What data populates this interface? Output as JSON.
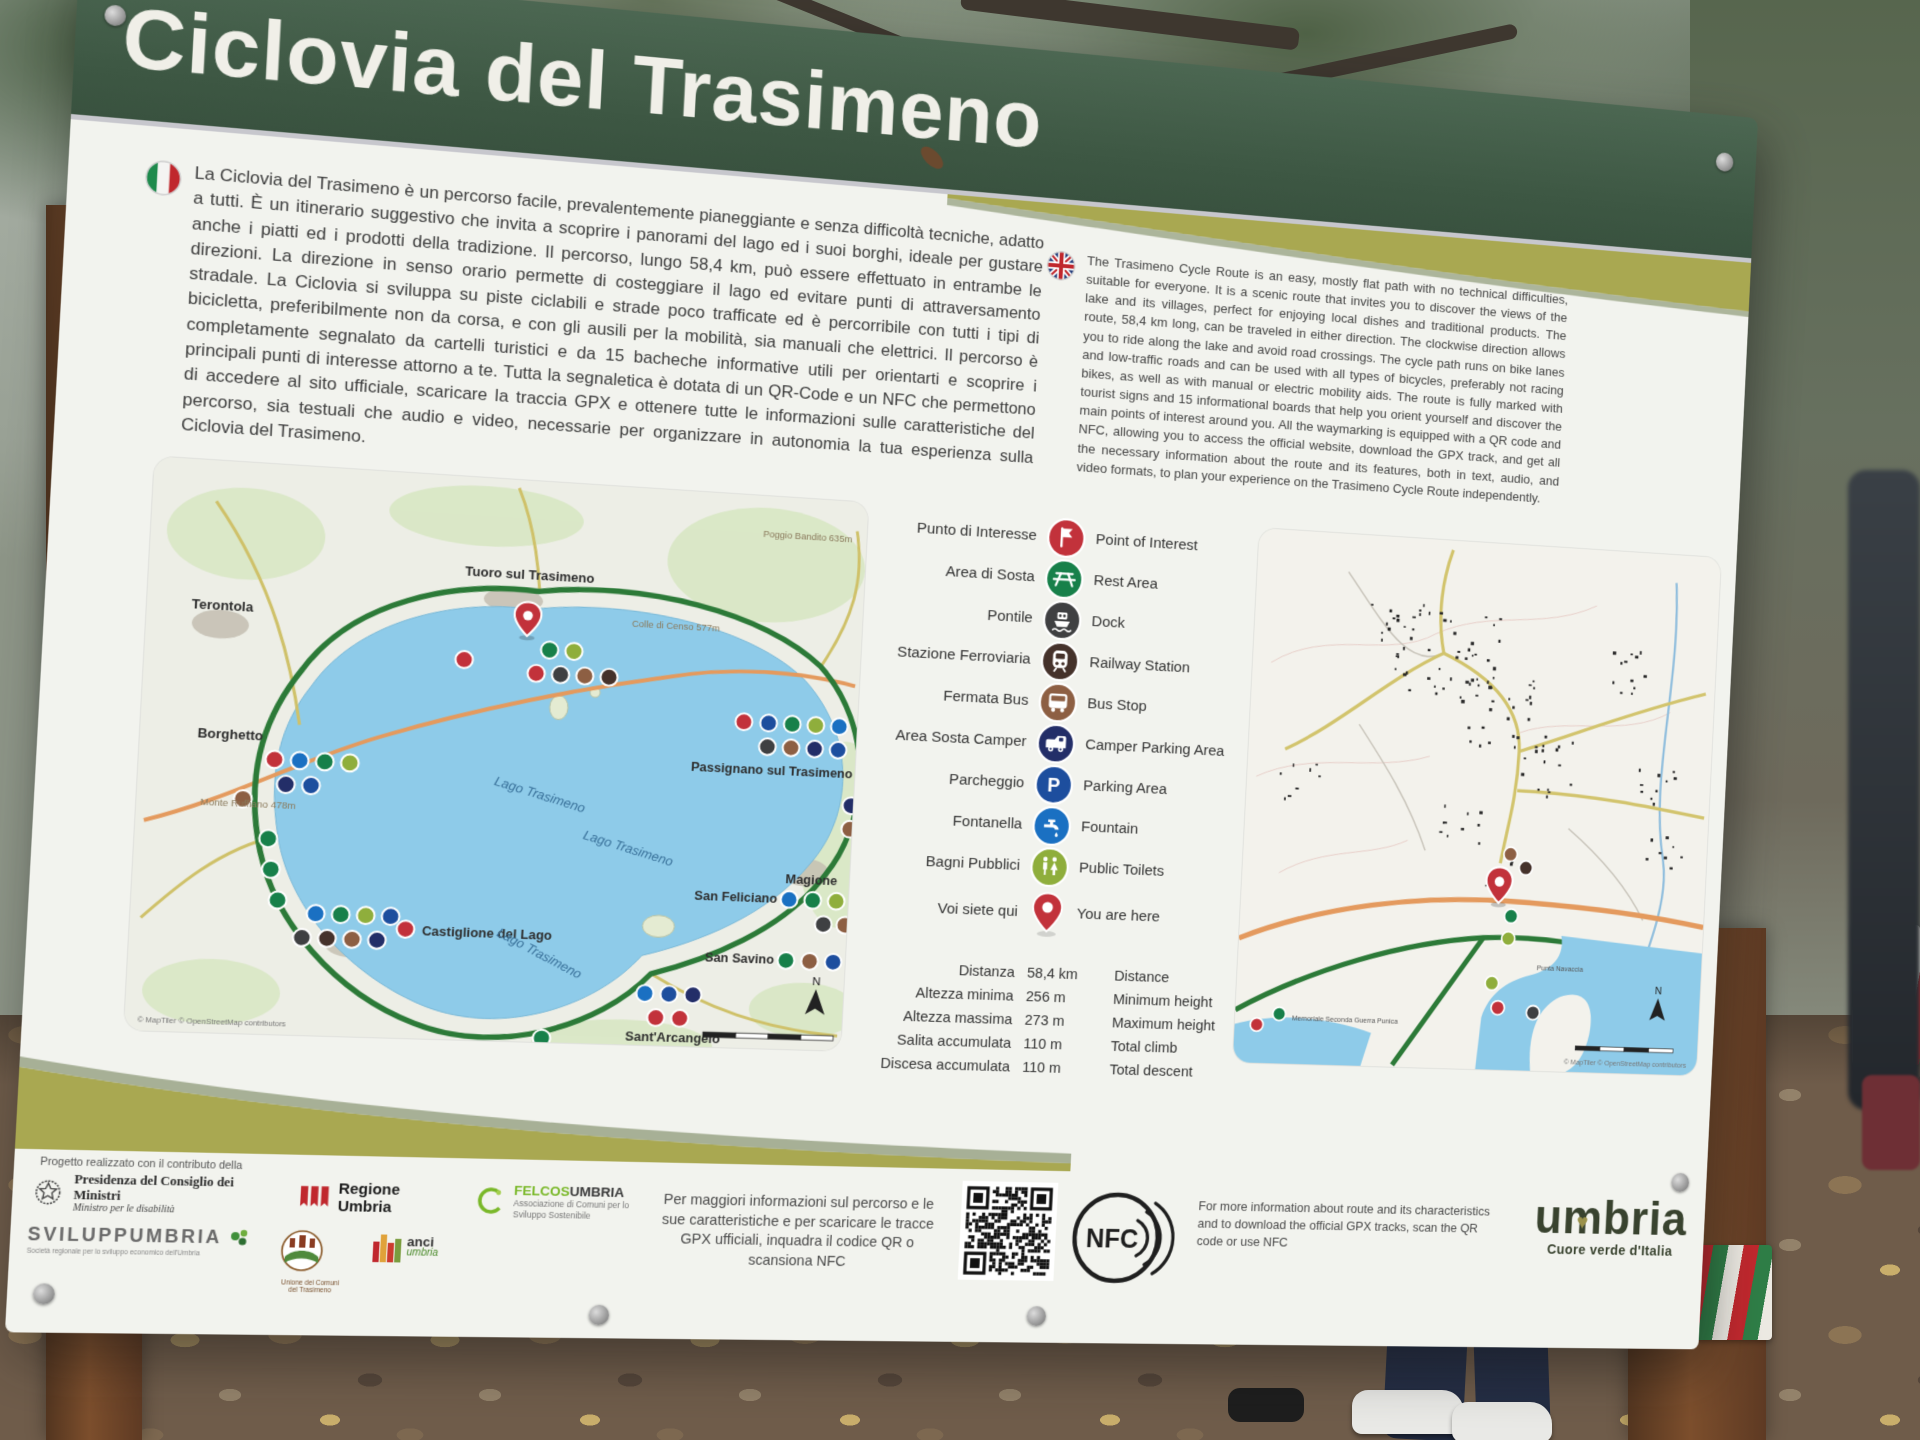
{
  "header": {
    "title": "Ciclovia del Trasimeno"
  },
  "intro": {
    "it": "La Ciclovia del Trasimeno è un percorso facile, prevalentemente pianeggiante e senza difficoltà tecniche, adatto a tutti. È un itinerario suggestivo che invita a scoprire i panorami del lago ed i suoi borghi, ideale per gustare anche i piatti ed i prodotti della tradizione. Il percorso, lungo 58,4 km, può essere effettuato in entrambe le direzioni. La direzione in senso orario permette di costeggiare il lago ed evitare punti di attraversamento stradale. La Ciclovia si sviluppa su piste ciclabili e strade poco trafficate ed è percorribile con tutti i tipi di bicicletta, preferibilmente non da corsa, e con gli ausili per la mobilità, sia manuali che elettrici. Il percorso è completamente segnalato da cartelli turistici e da 15 bacheche informative utili per orientarti e scoprire i principali punti di interesse attorno a te. Tutta la segnaletica è dotata di un QR-Code e un NFC che permettono di accedere al sito ufficiale, scaricare la traccia GPX e ottenere tutte le informazioni sulle caratteristiche del percorso, sia testuali che audio e video, necessarie per organizzare in autonomia la tua esperienza sulla Ciclovia del Trasimeno.",
    "en": "The Trasimeno Cycle Route is an easy, mostly flat path with no technical difficulties, suitable for everyone. It is a scenic route that invites you to discover the views of the lake and its villages, perfect for enjoying local dishes and traditional products. The route, 58,4 km long, can be traveled in either direction. The clockwise direction allows you to ride along the lake and avoid road crossings. The cycle path runs on bike lanes and low-traffic roads and can be used with all types of bicycles, preferably not racing bikes, as well as with manual or electric mobility aids. The route is fully marked with tourist signs and 15 informational boards that help you orient yourself and discover the main points of interest around you. All the waymarking is equipped with a QR code and NFC, allowing you to access the official website, download the GPX track, and get all the necessary information about the route and its features, both in text, audio, and video formats, to plan your experience on the Trasimeno Cycle Route independently."
  },
  "legend": {
    "parking_letter": "P",
    "items": [
      {
        "it": "Punto di Interesse",
        "en": "Point of Interest",
        "color": "#c2323b"
      },
      {
        "it": "Area di Sosta",
        "en": "Rest Area",
        "color": "#17804a"
      },
      {
        "it": "Pontile",
        "en": "Dock",
        "color": "#3f4042"
      },
      {
        "it": "Stazione Ferroviaria",
        "en": "Railway Station",
        "color": "#45322b"
      },
      {
        "it": "Fermata Bus",
        "en": "Bus Stop",
        "color": "#8d5f43"
      },
      {
        "it": "Area Sosta Camper",
        "en": "Camper Parking Area",
        "color": "#232e68"
      },
      {
        "it": "Parcheggio",
        "en": "Parking Area",
        "color": "#1d4e9e"
      },
      {
        "it": "Fontanella",
        "en": "Fountain",
        "color": "#1a70c2"
      },
      {
        "it": "Bagni Pubblici",
        "en": "Public Toilets",
        "color": "#8fae3c"
      },
      {
        "it": "Voi siete qui",
        "en": "You are here",
        "color": "#c2323b"
      }
    ]
  },
  "stats": {
    "rows": [
      {
        "it": "Distanza",
        "value": "58,4 km",
        "en": "Distance"
      },
      {
        "it": "Altezza minima",
        "value": "256 m",
        "en": "Minimum height"
      },
      {
        "it": "Altezza massima",
        "value": "273 m",
        "en": "Maximum height"
      },
      {
        "it": "Salita accumulata",
        "value": "110 m",
        "en": "Total climb"
      },
      {
        "it": "Discesa accumulata",
        "value": "110 m",
        "en": "Total descent"
      }
    ]
  },
  "map_main": {
    "lake_label": "Lago Trasimeno",
    "towns": {
      "terontola": "Terontola",
      "tuoro": "Tuoro sul Trasimeno",
      "passignano": "Passignano sul Trasimeno",
      "borghetto": "Borghetto",
      "castiglione": "Castiglione del Lago",
      "magione": "Magione",
      "san_feliciano": "San Feliciano",
      "san_savino": "San Savino",
      "sant_arcangelo": "Sant'Arcangelo"
    },
    "peaks": {
      "poggio_bandito": "Poggio Bandito 635m",
      "monte_ruffiano": "Monte Ruffiano 478m",
      "colle_censo": "Colle di Censo 577m"
    },
    "north": "N",
    "attribution": "© MapTiler © OpenStreetMap contributors"
  },
  "map_detail": {
    "punta": "Punta Navaccia",
    "memoriale": "Memoriale Seconda Guerra Punica",
    "north": "N",
    "attribution": "© MapTiler © OpenStreetMap contributors"
  },
  "footer": {
    "info_it": "Per maggiori informazioni sul percorso e le sue caratteristiche e per scaricare le tracce GPX ufficiali, inquadra il codice QR o scansiona NFC",
    "info_en": "For more information about route and its characteristics and to download the official GPX tracks, scan the QR code or use NFC",
    "nfc": "NFC"
  },
  "umbria": {
    "part1": "u",
    "part2": "m",
    "part3": "bria",
    "tagline": "Cuore verde d'Italia"
  },
  "partners": {
    "note": "Progetto realizzato con il contributo della",
    "presidenza_line1": "Presidenza del Consiglio dei Ministri",
    "presidenza_line2": "Ministro per le disabilità",
    "regione": "Regione Umbria",
    "felcos_name1": "FELCOS",
    "felcos_name2": "UMBRIA",
    "felcos_sub": "Associazione di Comuni per lo Sviluppo Sostenibile",
    "sviluppumbria": "SVILUPPUMBRIA",
    "sviluppumbria_sub": "Società regionale per lo sviluppo economico dell'Umbria",
    "unione": "Unione dei Comuni del Trasimeno",
    "anci_name": "anci",
    "anci_sub": "umbria"
  },
  "colors": {
    "header_green": "#3d5743",
    "accent_olive": "#a9a851",
    "lake_blue": "#8ecbe9",
    "route_green": "#2c7a38"
  }
}
